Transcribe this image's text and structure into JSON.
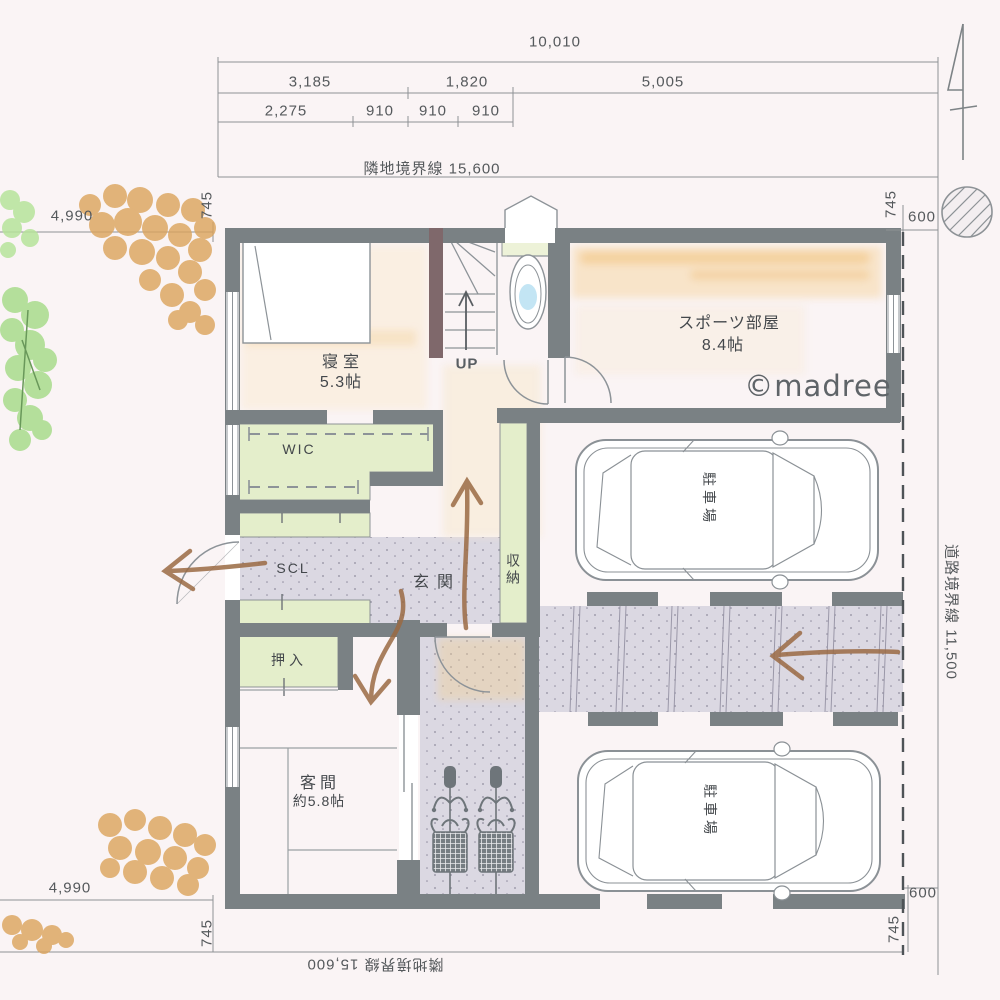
{
  "site": {
    "top": {
      "total_width": "10,010",
      "segments_row2": [
        {
          "label": "3,185"
        },
        {
          "label": "1,820"
        },
        {
          "label": "5,005"
        }
      ],
      "segments_row3": [
        {
          "label": "2,275"
        },
        {
          "label": "910"
        },
        {
          "label": "910"
        },
        {
          "label": "910"
        }
      ],
      "boundary_label": "隣地境界線 15,600"
    },
    "left": {
      "width_top": "4,990",
      "width_bottom": "4,990",
      "setback_top": "745",
      "setback_bottom": "745"
    },
    "right": {
      "setback_top": "745",
      "edge_top": "600",
      "setback_bottom": "745",
      "edge_bottom": "600",
      "road_boundary_label": "道路境界線 11,500"
    },
    "bottom": {
      "boundary_label": "隣地境界線 15,600"
    }
  },
  "rooms": {
    "bedroom_name": "寝室",
    "bedroom_size": "5.3帖",
    "sports_name": "スポーツ部屋",
    "sports_size": "8.4帖",
    "wic": "WIC",
    "scl": "SCL",
    "entrance": "玄関",
    "storage": "収納",
    "closet": "押入",
    "guest_name": "客間",
    "guest_size": "約5.8帖",
    "stairs_up": "UP",
    "parking_1": "駐車場",
    "parking_2": "駐車場"
  },
  "watermark": "©madree",
  "icons": {
    "north_arrow": "north-arrow",
    "site_tree_circle": "hatched-circle-tree",
    "foliage": "hand-drawn-foliage",
    "flow_arrows": "hand-drawn-flow-arrows"
  },
  "colors": {
    "wall": "#7a8184",
    "stair_wall": "#7f686b",
    "room_green": "#e4eecb",
    "floor_gray": "#dbd8e2",
    "highlight_orange": "#f3cf92",
    "foliage_orange": "#dba35b",
    "foliage_green": "#a7db8b",
    "arrow_brown": "#9a6a43",
    "toilet_water": "#b9e0f2"
  }
}
